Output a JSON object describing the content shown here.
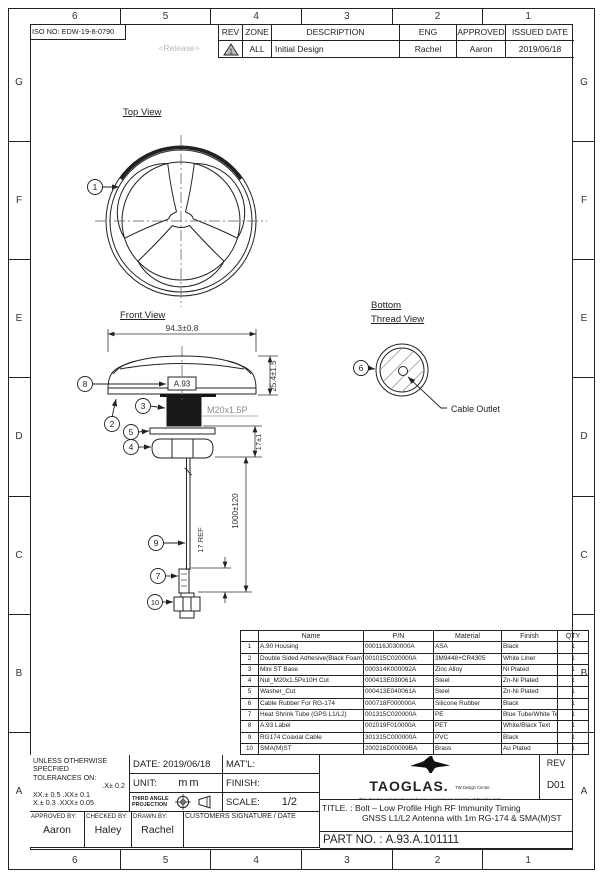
{
  "colors": {
    "line": "#222222",
    "release_gray": "#b8b8b8",
    "thread_label_gray": "#8a8a8a"
  },
  "zones": {
    "columns": [
      "6",
      "5",
      "4",
      "3",
      "2",
      "1"
    ],
    "rows": [
      "G",
      "F",
      "E",
      "D",
      "C",
      "B",
      "A"
    ]
  },
  "header": {
    "iso_no": "ISO NO: EDW-19-8-0790",
    "release": "<Release>",
    "rev_table": {
      "col_rev": "REV",
      "col_zone": "ZONE",
      "col_description": "DESCRIPTION",
      "col_eng": "ENG",
      "col_approved": "APPROVED",
      "col_issued": "ISSUED DATE",
      "row": {
        "rev_mark": "1",
        "zone": "ALL",
        "description": "Initial Design",
        "eng": "Rachel",
        "approved": "Aaron",
        "issued": "2019/06/18"
      }
    }
  },
  "drawing": {
    "top_view": {
      "title": "Top View",
      "callout": "1"
    },
    "front_view": {
      "title": "Front View",
      "label": "A.93",
      "dim_width": "94.3±0.8",
      "dim_height": "25.4±1.5",
      "thread": "M20x1.5P",
      "dim_stud": "17±1",
      "dim_cable": "1000±120",
      "dim_shrink": "17 REF",
      "callout_housing": "8",
      "callout_adhesive": "2",
      "callout_thread": "3",
      "callout_washer": "5",
      "callout_nut": "4",
      "callout_cable": "9",
      "callout_shrink": "7",
      "callout_connector": "10"
    },
    "bottom_view": {
      "title_line1": "Bottom",
      "title_line2": "Thread View",
      "callout": "6",
      "outlet_label": "Cable Outlet"
    }
  },
  "bom": {
    "headers": [
      "",
      "Name",
      "P/N",
      "Material",
      "Finish",
      "QTY"
    ],
    "rows": [
      [
        "1",
        "A.90 Housing",
        "000116J030000A",
        "ASA",
        "Black",
        "1"
      ],
      [
        "2",
        "Double Sided Adhesive(Black Foam)",
        "001015C020000A",
        "3M9448+CR4305",
        "White Liner",
        "1"
      ],
      [
        "3",
        "Mini ST Base",
        "000314K000092A",
        "Zinc Alloy",
        "Ni Plated",
        "1"
      ],
      [
        "4",
        "Nut_M20x1.5Px10H Cut",
        "000413E030061A",
        "Steel",
        "Zn-Ni Plated",
        "1"
      ],
      [
        "5",
        "Washer_Cut",
        "000413E040061A",
        "Steel",
        "Zn-Ni Plated",
        "1"
      ],
      [
        "6",
        "Cable Rubber For RG-174",
        "000718F000000A",
        "Silicone Rubber",
        "Black",
        "1"
      ],
      [
        "7",
        "Heat Shrink Tube (GPS L1/L2)",
        "001315C020000A",
        "PE",
        "Blue Tube/White Text",
        "1"
      ],
      [
        "8",
        "A.93 Label",
        "001019F010000A",
        "PET",
        "White/Black Text",
        "1"
      ],
      [
        "9",
        "RG174 Coaxial Cable",
        "301315C000000A",
        "PVC",
        "Black",
        "1"
      ],
      [
        "10",
        "SMA(M)ST",
        "200216D00009BA",
        "Brass",
        "Au Plated",
        "1"
      ]
    ]
  },
  "title_block": {
    "tol_line1": "UNLESS OTHERWISE",
    "tol_line2": "SPECFIED",
    "tol_line3": "TOLERANCES ON:",
    "tol_line4": ".X± 0.2",
    "tol_line5": "XX.± 0.5  .XX± 0.1",
    "tol_line6": "X.± 0.3 .XXX± 0.05",
    "date_label": "DATE:",
    "date_value": "2019/06/18",
    "unit_label": "UNIT:",
    "unit_value": "mm",
    "matl_label": "MAT'L:",
    "finish_label": "FINISH:",
    "projection_line1": "THIRD ANGLE",
    "projection_line2": "PROJECTION",
    "scale_label": "SCALE:",
    "scale_value": "1/2",
    "approved_label": "APPROVED BY:",
    "approved_value": "Aaron",
    "checked_label": "CHECKED BY:",
    "checked_value": "Haley",
    "drawn_label": "DRAWN BY:",
    "drawn_value": "Rachel",
    "customer_label": "CUSTOMERS SIGNATURE / DATE",
    "brand": "TAOGLAS.",
    "brand_sub": "TW Design Centre",
    "disclaimer_line1": "This drawing and its inherent design concepts are property of Taoglas. Not",
    "disclaimer_line2": "to be copied or given to third parties without the written consent of Taoglas.",
    "rev_label": "REV",
    "rev_value": "D01",
    "title_label": "TITLE.",
    "title_line1": ": Bolt – Low Profile High RF Immunity Timing",
    "title_line2": "GNSS L1/L2 Antenna with 1m RG-174 & SMA(M)ST",
    "part_label": "PART NO. :",
    "part_value": "A.93.A.101111"
  }
}
